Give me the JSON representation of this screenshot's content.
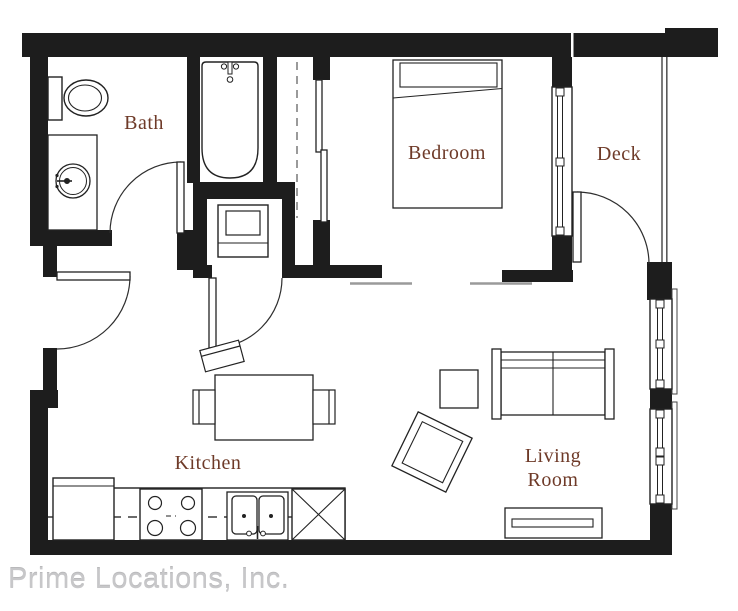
{
  "page": {
    "width": 738,
    "height": 611,
    "background": "#ffffff"
  },
  "floorplan": {
    "rooms": {
      "bath": {
        "label": "Bath"
      },
      "bedroom": {
        "label": "Bedroom"
      },
      "deck": {
        "label": "Deck"
      },
      "kitchen": {
        "label": "Kitchen"
      },
      "living_room": {
        "label": "Living Room",
        "line1": "Living",
        "line2": "Room"
      }
    },
    "label_color": "#6e3a28",
    "wall_color": "#1d1d1d",
    "line_color": "#2e2e2e",
    "railing_color": "#5a5a5a",
    "dashed_color": "#6f6f6f"
  },
  "footer": {
    "company_name": "Prime Locations, Inc.",
    "text_color": "#c7c7c9"
  }
}
